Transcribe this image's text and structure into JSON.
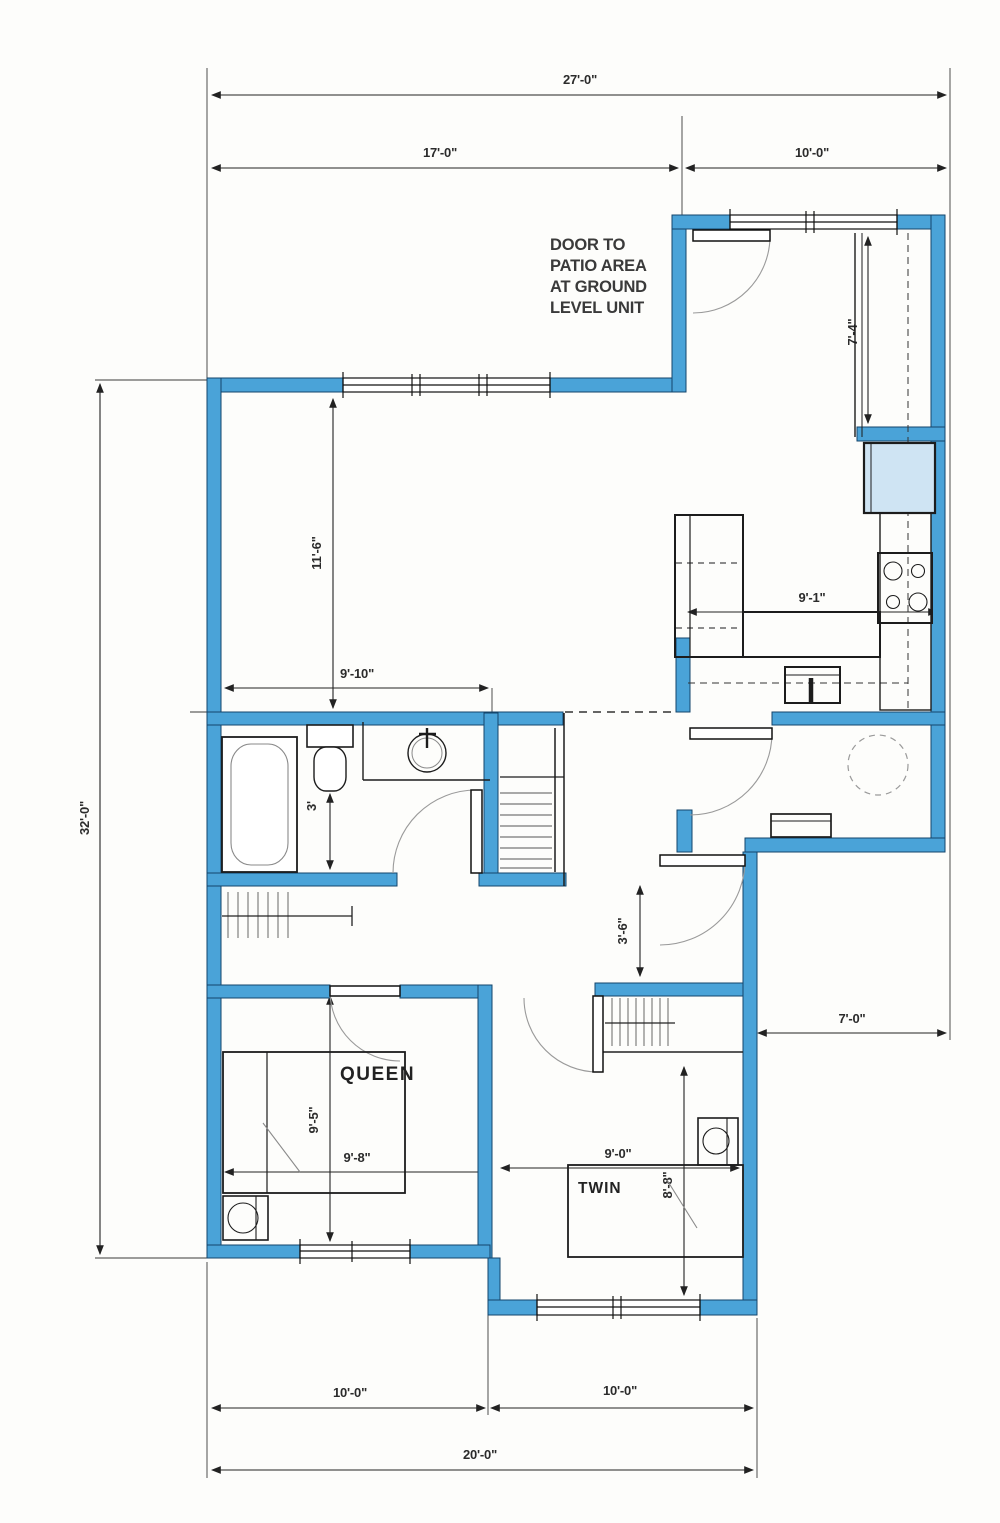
{
  "colors": {
    "wall_fill": "#4aa3d8",
    "wall_edge": "#14456b",
    "line_black": "#1c1c1c",
    "arc_gray": "#9a9a9a",
    "fridge_fill": "#cfe4f3",
    "paper": "#fdfdfb"
  },
  "notes": {
    "door_note_lines": [
      "DOOR TO",
      "PATIO AREA",
      "AT GROUND",
      "LEVEL UNIT"
    ]
  },
  "rooms": {
    "queen": "QUEEN",
    "twin": "TWIN"
  },
  "dimensions": {
    "overall_width": "27'-0\"",
    "upper_left_width": "17'-0\"",
    "upper_right_width": "10'-0\"",
    "overall_height": "32'-0\"",
    "patio_closet_height": "7'-4\"",
    "living_height": "11'-6\"",
    "living_width": "9'-10\"",
    "kitchen_width": "9'-1\"",
    "bath_offset": "3'",
    "hall_width": "3'-6\"",
    "entry_width": "7'-0\"",
    "queen_depth": "9'-5\"",
    "queen_width": "9'-8\"",
    "twin_width": "9'-0\"",
    "twin_depth": "8'-8\"",
    "bottom_left_width": "10'-0\"",
    "bottom_right_width": "10'-0\"",
    "bottom_overall_width": "20'-0\""
  }
}
